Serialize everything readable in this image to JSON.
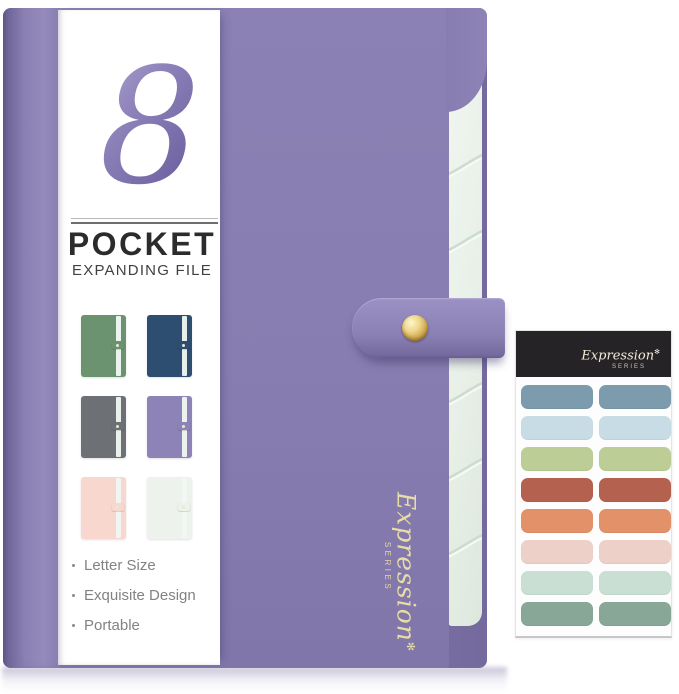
{
  "product": {
    "pocket_count": "8",
    "title": "POCKET",
    "subtitle": "EXPANDING FILE",
    "features": [
      "Letter Size",
      "Exquisite Design",
      "Portable"
    ],
    "brand": {
      "script": "Expression",
      "series": "SERIES",
      "star_glyph": "✻"
    },
    "colors": {
      "folder_purple": "#877db0",
      "spine_purple": "#6f6599",
      "pages_mint": "#eaf1ea",
      "snap_gold": "#d1ab52",
      "script_gold": "#e9dda6"
    }
  },
  "color_swatches": [
    {
      "name": "green",
      "color": "#6b9370"
    },
    {
      "name": "navy",
      "color": "#2d4d71"
    },
    {
      "name": "gray",
      "color": "#6d7176"
    },
    {
      "name": "purple",
      "color": "#8d83b6"
    },
    {
      "name": "pink",
      "color": "#f7d7ce"
    },
    {
      "name": "mint-white",
      "color": "#edf2ec"
    }
  ],
  "sticker_sheet": {
    "brand": {
      "script": "Expression",
      "series": "SERIES",
      "star_glyph": "✻"
    },
    "header_color": "#262326",
    "sticker_colors": [
      "#7c9cad",
      "#c7dce5",
      "#bccd95",
      "#b5614f",
      "#e39168",
      "#edd0c7",
      "#c9dfd3",
      "#89a797"
    ]
  }
}
